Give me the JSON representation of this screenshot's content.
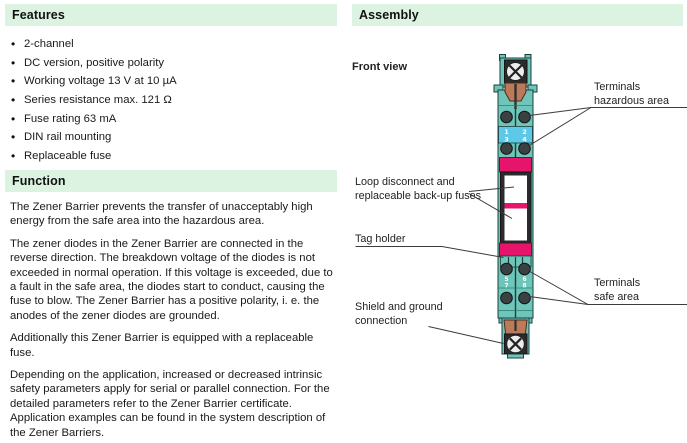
{
  "features": {
    "title": "Features",
    "items": [
      "2-channel",
      "DC version, positive polarity",
      "Working voltage 13 V at 10 µA",
      "Series resistance max. 121 Ω",
      "Fuse rating 63 mA",
      "DIN rail mounting",
      "Replaceable fuse"
    ]
  },
  "function_section": {
    "title": "Function",
    "paragraphs": [
      "The Zener Barrier prevents the transfer of unacceptably high energy from the safe area into the hazardous area.",
      "The zener diodes in the Zener Barrier are connected in the reverse direction. The breakdown voltage of the diodes is not exceeded in normal operation. If this voltage is exceeded, due to a fault in the safe area, the diodes start to conduct, causing the fuse to blow. The Zener Barrier has a positive polarity, i. e. the anodes of the zener diodes are grounded.",
      "Additionally this Zener Barrier is equipped with a replaceable fuse.",
      "Depending on the application, increased or decreased intrinsic safety parameters apply for serial or parallel connection. For the detailed parameters refer to the Zener Barrier certificate. Application examples can be found in the system description of the Zener Barriers."
    ]
  },
  "assembly": {
    "title": "Assembly",
    "front_view": "Front view",
    "labels": {
      "hazardous": [
        "Terminals",
        "hazardous area"
      ],
      "loop": [
        "Loop disconnect and",
        "replaceable back-up fuses"
      ],
      "tag": [
        "Tag holder"
      ],
      "safe": [
        "Terminals",
        "safe area"
      ],
      "shield": [
        "Shield and ground",
        "connection"
      ]
    },
    "terminals": {
      "hazardous": [
        "1",
        "2",
        "3",
        "4"
      ],
      "safe": [
        "5",
        "6",
        "7",
        "8"
      ]
    }
  },
  "colors": {
    "section_header_bg": "#dcf3e2",
    "device_teal": "#6ec6ba",
    "device_outline": "#1e3f3b",
    "terminal_band_blue": "#5cc9e8",
    "magenta": "#e5156b",
    "copper": "#bd7a5a",
    "terminal_screw": "#3a4143",
    "leader_line": "#3c3c3c"
  }
}
